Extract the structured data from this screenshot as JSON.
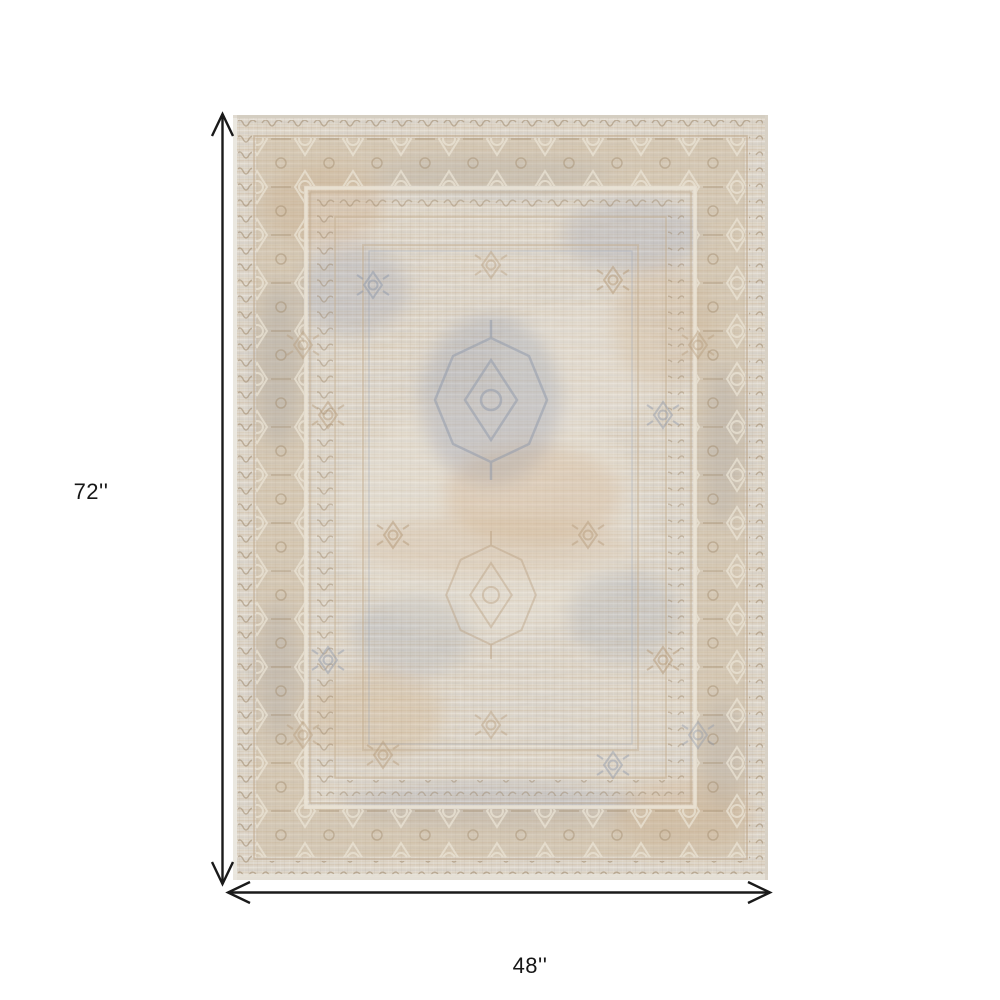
{
  "canvas": {
    "width": 1000,
    "height": 1000,
    "background": "#ffffff"
  },
  "annotations": {
    "height_label": "72''",
    "width_label": "48''",
    "arrow_color": "#1a1a1a",
    "label_color": "#161616"
  },
  "rug": {
    "description": "Faded vintage oriental-style area rug in cream, beige, tan and gray-blue with distressed border and medallion pattern",
    "colors": {
      "base": "#ddd4c6",
      "cream": "#ebe4d6",
      "tan": "#c9b396",
      "dark_tan": "#b59a79",
      "gray_blue": "#939dae",
      "edge": "#cdc6b9"
    }
  }
}
